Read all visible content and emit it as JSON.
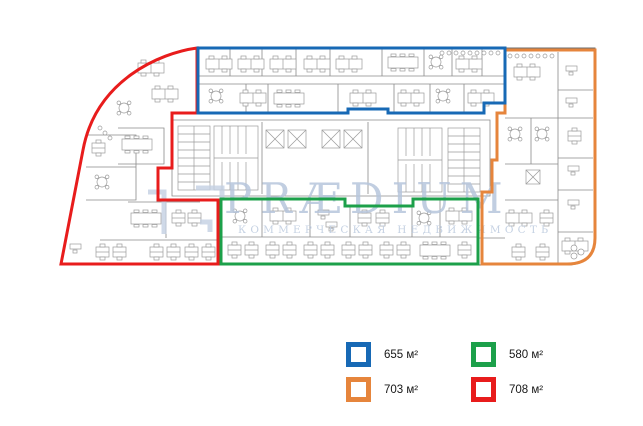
{
  "watermark": {
    "brand": "PRÆDIUM",
    "tagline": "КОММЕРЧЕСКАЯ НЕДВИЖИМОСТЬ"
  },
  "zones": [
    {
      "id": "blue",
      "color": "#1769b5",
      "area_label": "655 м²"
    },
    {
      "id": "green",
      "color": "#1ca04a",
      "area_label": "580 м²"
    },
    {
      "id": "orange",
      "color": "#e6853c",
      "area_label": "703 м²"
    },
    {
      "id": "red",
      "color": "#e81c1c",
      "area_label": "708 м²"
    }
  ],
  "plan": {
    "type": "office-floor-plan",
    "zone_outline_widths_px": 3,
    "background": "#ffffff"
  }
}
